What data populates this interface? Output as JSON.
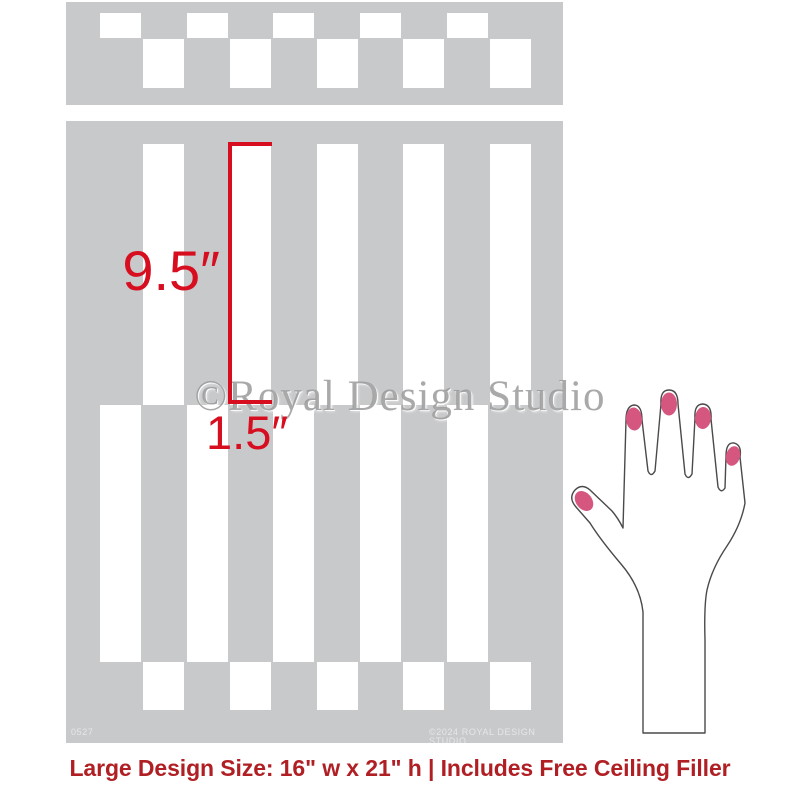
{
  "colors": {
    "background": "#ffffff",
    "stencil_gray": "#c8c9cb",
    "dimension_red": "#d60e1f",
    "caption_red": "#b01f24",
    "nail_pink": "#d5567f",
    "hand_outline": "#4a4a4a",
    "watermark_gray": "#969696",
    "fine_print_white": "rgba(255,255,255,0.55)"
  },
  "stencil": {
    "hole_width": 41,
    "ceiling_filler_bar": {
      "panel": {
        "x": 66,
        "y": 2,
        "w": 497,
        "h": 103
      },
      "rows": [
        {
          "y": 13,
          "h": 25,
          "xs": [
            100,
            187,
            273,
            360,
            447
          ]
        },
        {
          "y": 39,
          "h": 49,
          "xs": [
            143,
            230,
            317,
            403,
            490
          ]
        }
      ]
    },
    "main_panel": {
      "panel": {
        "x": 66,
        "y": 121,
        "w": 497,
        "h": 622
      },
      "rows": [
        {
          "y": 144,
          "h": 261,
          "xs": [
            143,
            230,
            317,
            403,
            490
          ]
        },
        {
          "y": 405,
          "h": 257,
          "xs": [
            100,
            187,
            273,
            360,
            447
          ]
        },
        {
          "y": 662,
          "h": 48,
          "xs": [
            143,
            230,
            317,
            403,
            490
          ]
        }
      ]
    }
  },
  "dimensions": {
    "stripe_height_label": "9.5″",
    "stripe_width_label": "1.5″",
    "bracket": {
      "x": 228,
      "top": 142,
      "bottom": 404,
      "tick_length": 44,
      "thickness": 4
    }
  },
  "watermark": {
    "text": "©Royal Design Studio"
  },
  "fine_print": {
    "sku": "0527",
    "copyright": "©2024 ROYAL DESIGN STUDIO"
  },
  "caption": {
    "text": "Large Design Size: 16\" w x 21\" h | Includes Free Ceiling Filler"
  }
}
